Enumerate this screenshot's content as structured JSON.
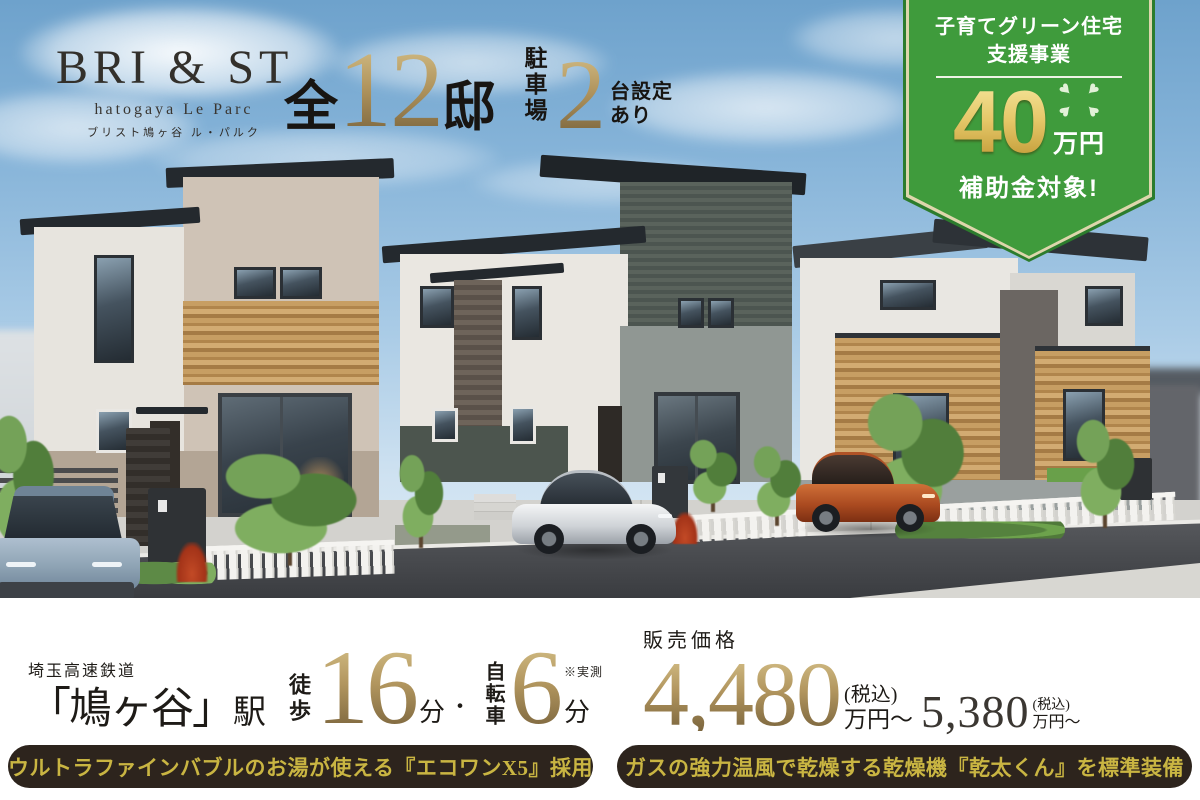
{
  "logo": {
    "brand": "BRI & ST",
    "sub_en": "hatogaya Le Parc",
    "sub_jp": "ブリスト鳩ヶ谷 ル・パルク"
  },
  "headline": {
    "total_prefix": "全",
    "total_count": "12",
    "total_suffix": "邸",
    "parking_label": "駐車場",
    "parking_count": "2",
    "parking_note_line1": "台設定",
    "parking_note_line2": "あり"
  },
  "badge": {
    "title_line1": "子育てグリーン住宅",
    "title_line2": "支援事業",
    "amount": "40",
    "amount_unit": "万円",
    "caption": "補助金対象!",
    "green": "#3f9b3c"
  },
  "access": {
    "railway": "埼玉高速鉄道",
    "station": "「鳩ヶ谷」",
    "station_suffix": "駅",
    "walk_label": "徒歩",
    "walk_minutes": "16",
    "walk_unit": "分",
    "separator": "・",
    "bike_label": "自転車",
    "bike_minutes": "6",
    "bike_unit": "分",
    "note": "※実測"
  },
  "price": {
    "label": "販売価格",
    "min": "4,480",
    "min_tax": "(税込)",
    "min_unit": "万円〜",
    "max": "5,380",
    "max_tax": "(税込)",
    "max_unit": "万円〜"
  },
  "features": {
    "left": "ウルトラファインバブルのお湯が使える『エコワンX5』採用",
    "right": "ガスの強力温風で乾燥する乾燥機『乾太くん』を標準装備"
  },
  "colors": {
    "gold_light": "#d0ba82",
    "gold_dark": "#7c663e",
    "badge_green": "#3f9b3c",
    "pill_bg": "#2d241d",
    "pill_text": "#c9b542"
  }
}
